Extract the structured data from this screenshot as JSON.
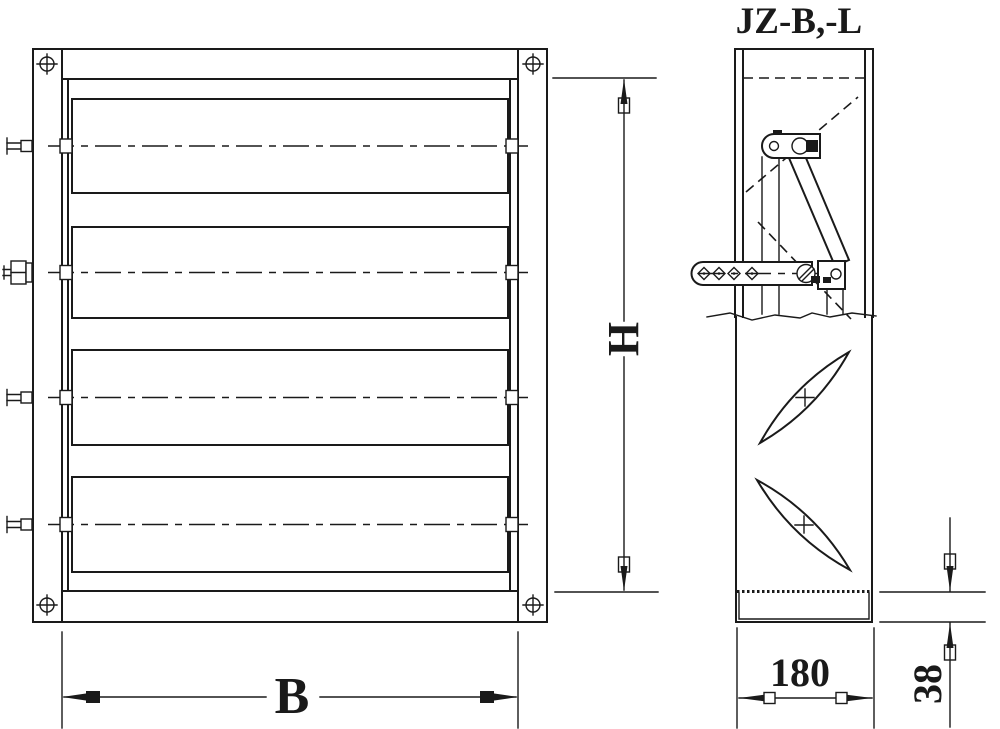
{
  "labels": {
    "title": "JZ-B,-L",
    "height_dim": "H",
    "width_dim": "B",
    "depth_dim": "180",
    "flange_dim": "38"
  },
  "drawing": {
    "views": [
      "front-elevation-louver-damper",
      "side-section-blade-linkage"
    ],
    "blade_count_front": 4,
    "blade_sections_side": 2
  },
  "colors": {
    "line": "#1a1a1a",
    "background": "#ffffff"
  }
}
